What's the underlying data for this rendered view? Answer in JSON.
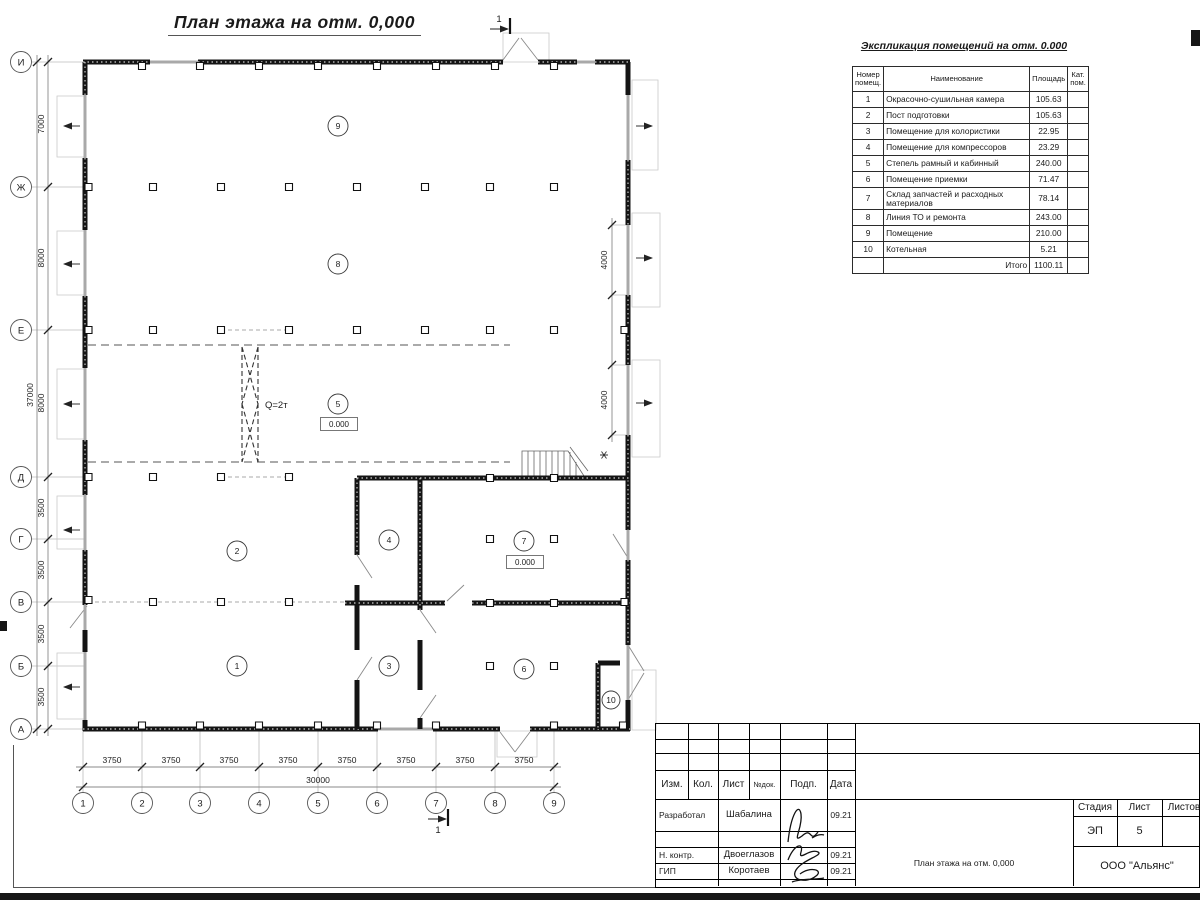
{
  "header": {
    "title": "План этажа на отм. 0,000"
  },
  "plan": {
    "rooms": [
      "1",
      "2",
      "3",
      "4",
      "5",
      "6",
      "7",
      "8",
      "9",
      "10"
    ],
    "elevation": "0.000",
    "crane": "Q=2т",
    "section": "1"
  },
  "axes": {
    "rows": [
      "И",
      "Ж",
      "Е",
      "Д",
      "Г",
      "В",
      "Б",
      "А"
    ],
    "cols": [
      "1",
      "2",
      "3",
      "4",
      "5",
      "6",
      "7",
      "8",
      "9"
    ]
  },
  "dims": {
    "left": [
      "7000",
      "8000",
      "8000",
      "3500",
      "3500",
      "3500",
      "3500"
    ],
    "left_total": "37000",
    "bottom": [
      "3750",
      "3750",
      "3750",
      "3750",
      "3750",
      "3750",
      "3750",
      "3750"
    ],
    "bottom_total": "30000",
    "right": [
      "4000",
      "4000"
    ]
  },
  "expl": {
    "title": "Экспликация помещений на отм. 0.000",
    "h_num": "Номер помещ.",
    "h_name": "Наименование",
    "h_area": "Площадь",
    "h_cat": "Кат. пом.",
    "rows": [
      {
        "num": "1",
        "name": "Окрасочно-сушильная камера",
        "area": "105.63",
        "cat": ""
      },
      {
        "num": "2",
        "name": "Пост подготовки",
        "area": "105.63",
        "cat": ""
      },
      {
        "num": "3",
        "name": "Помещение для колористики",
        "area": "22.95",
        "cat": ""
      },
      {
        "num": "4",
        "name": "Помещение для компрессоров",
        "area": "23.29",
        "cat": ""
      },
      {
        "num": "5",
        "name": "Степель рамный и кабинный",
        "area": "240.00",
        "cat": ""
      },
      {
        "num": "6",
        "name": "Помещение приемки",
        "area": "71.47",
        "cat": ""
      },
      {
        "num": "7",
        "name": "Склад запчастей и расходных материалов",
        "area": "78.14",
        "cat": ""
      },
      {
        "num": "8",
        "name": "Линия ТО и ремонта",
        "area": "243.00",
        "cat": ""
      },
      {
        "num": "9",
        "name": "Помещение",
        "area": "210.00",
        "cat": ""
      },
      {
        "num": "10",
        "name": "Котельная",
        "area": "5.21",
        "cat": ""
      }
    ],
    "total_label": "Итого",
    "total_value": "1100.11"
  },
  "tb": {
    "cols": [
      "Изм.",
      "Кол.",
      "Лист",
      "№док.",
      "Подп.",
      "Дата"
    ],
    "people": [
      {
        "role": "Разработал",
        "name": "Шабалина",
        "date": "09.21"
      },
      {
        "role": "Н. контр.",
        "name": "Двоеглазов",
        "date": "09.21"
      },
      {
        "role": "ГИП",
        "name": "Коротаев",
        "date": "09.21"
      }
    ],
    "doc_title": "План этажа на отм. 0,000",
    "company": "ООО \"Альянс\"",
    "stage_label": "Стадия",
    "sheet_label": "Лист",
    "sheets_label": "Листов",
    "stage": "ЭП",
    "sheet": "5"
  }
}
